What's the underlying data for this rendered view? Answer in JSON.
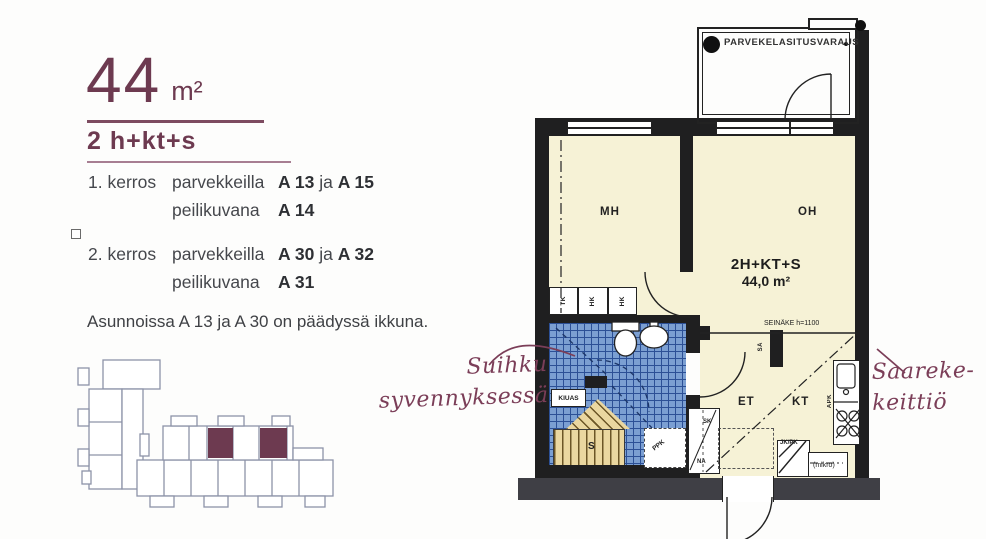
{
  "header": {
    "area": "44",
    "unit": "m²",
    "type": "2 h+kt+s"
  },
  "floors": [
    {
      "floor": "1. kerros",
      "word1": "parvekkeilla",
      "code_a": "A 13",
      "conj": "ja",
      "code_b": "A 15",
      "word2": "peilikuvana",
      "code_c": "A 14"
    },
    {
      "floor": "2. kerros",
      "word1": "parvekkeilla",
      "code_a": "A 30",
      "conj": "ja",
      "code_b": "A 32",
      "word2": "peilikuvana",
      "code_c": "A 31"
    }
  ],
  "note": "Asunnoissa A 13 ja A 30 on päädyssä ikkuna.",
  "annotations": {
    "shower": {
      "line1": "Suihku",
      "line2": "syvennyksessä"
    },
    "kitchen": {
      "line1": "Saareke-",
      "line2": "keittiö"
    }
  },
  "plan": {
    "balcony": "PARVEKELASITUSVARAUS",
    "apartment": {
      "code": "2H+KT+S",
      "area": "44,0 m²"
    },
    "rooms": {
      "mh": "MH",
      "oh": "OH",
      "et": "ET",
      "kt": "KT",
      "s": "S"
    },
    "partition": "SEINÄKE h=1100",
    "closets": {
      "tk": "TK",
      "hk1": "HK",
      "hk2": "HK",
      "sk": "SK",
      "na": "NA",
      "sa": "SÄ"
    },
    "fixtures": {
      "kiuas": "KIUAS",
      "ppk": "PPK",
      "apk": "APK",
      "jkpk": "JK/PK",
      "mikro": "(mikro)"
    }
  },
  "colors": {
    "accent_maroon": "#6d3a50",
    "wall_black": "#1f1f20",
    "wall_gray": "#3f3f45",
    "floor_cream": "#f6f2d6",
    "tile_blue": "#7b9fd2",
    "tile_grout": "#2c5096",
    "bench_tan": "#ead7a0"
  }
}
